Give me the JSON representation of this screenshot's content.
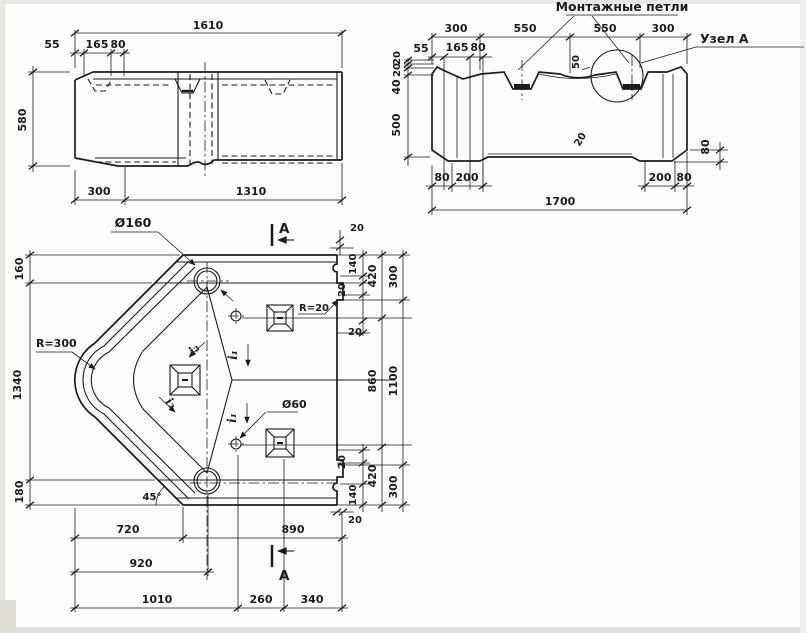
{
  "side_view": {
    "dim_overall": "1610",
    "dim_55": "55",
    "dim_165": "165",
    "dim_80": "80",
    "dim_height": "580",
    "dim_300": "300",
    "dim_1310": "1310"
  },
  "section_view": {
    "mounting_loops_label": "Монтажные петли",
    "node_a_label": "Узел А",
    "dim_300_l": "300",
    "dim_550_l": "550",
    "dim_550_r": "550",
    "dim_300_r": "300",
    "dim_55": "55",
    "dim_165": "165",
    "dim_80_top": "80",
    "dim_20_a": "20",
    "dim_20_b": "20",
    "dim_40": "40",
    "dim_500": "500",
    "dim_50": "50",
    "dim_20_slope": "20",
    "dim_80_right": "80",
    "dim_80_bl": "80",
    "dim_200_bl": "200",
    "dim_200_br": "200",
    "dim_80_br": "80",
    "dim_overall": "1700"
  },
  "plan_view": {
    "dia_160_label": "Ø160",
    "dia_60_label": "Ø60",
    "r300_label": "R=300",
    "r20_label": "R=20",
    "angle_label": "45°",
    "i1_label": "i₁",
    "i2_label": "i₂",
    "section_letter": "A",
    "dim_160": "160",
    "dim_1340": "1340",
    "dim_180": "180",
    "dim_20_tr": "20",
    "dim_140_t": "140",
    "dim_20_r1": "20",
    "dim_20_r2": "20",
    "dim_420_t": "420",
    "dim_300_t": "300",
    "dim_860": "860",
    "dim_1100": "1100",
    "dim_20_r3": "20",
    "dim_140_b": "140",
    "dim_420_b": "420",
    "dim_300_b": "300",
    "dim_20_br": "20",
    "dim_720": "720",
    "dim_890": "890",
    "dim_920": "920",
    "dim_1010": "1010",
    "dim_260": "260",
    "dim_340": "340"
  }
}
